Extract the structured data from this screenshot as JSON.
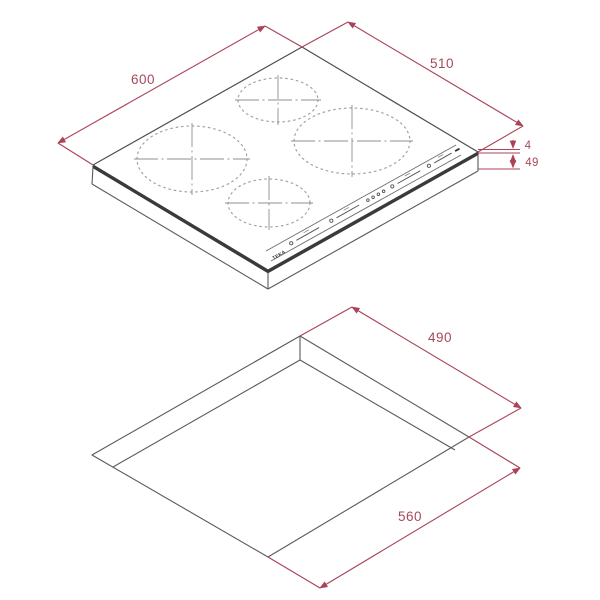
{
  "hob": {
    "logo": "TEKA",
    "dim_width": "600",
    "dim_depth": "510",
    "dim_glass_thickness": "4",
    "dim_total_height": "49"
  },
  "cutout": {
    "dim_depth": "490",
    "dim_width": "560"
  },
  "colors": {
    "dimension_red": "#AA4258",
    "outline_grey": "#4E4E4E",
    "zone_dot_grey": "#A2A2A2",
    "glass_edge_dark": "#3A3A3A",
    "background": "#FFFFFF"
  }
}
